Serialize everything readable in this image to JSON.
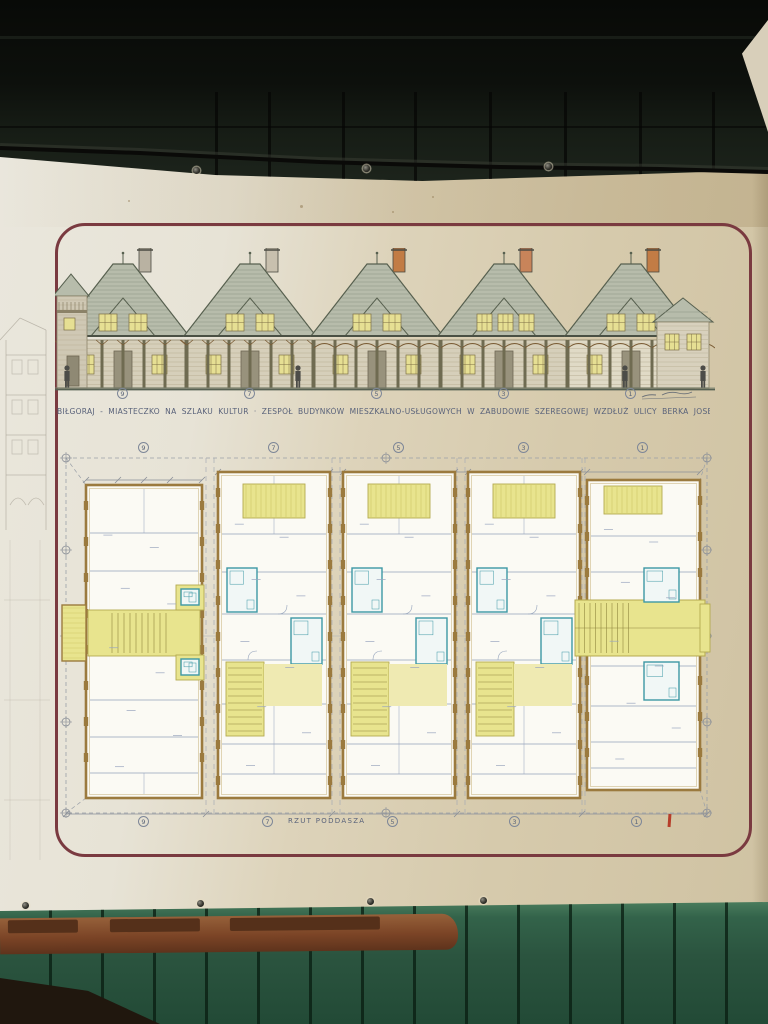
{
  "banner": {
    "caption": "BIŁGORAJ - MIASTECZKO NA SZLAKU KULTUR · ZESPÓŁ BUDYNKÓW MIESZKALNO-USŁUGOWYCH W ZABUDOWIE SZEREGOWEJ WZDŁUŻ ULICY BERKA JOSELEWICZA",
    "plan_label": "RZUT PODDASZA",
    "building_numbers": [
      "9",
      "7",
      "5",
      "3",
      "1"
    ],
    "elevation_numbers": [
      "9",
      "7",
      "5",
      "3",
      "1"
    ]
  },
  "colors": {
    "frame": "#7a3a40",
    "ink": "#5a6478",
    "plan_yellow": "#e8e48e",
    "plan_yellow_dark": "#b4a94f",
    "plan_teal": "#3d98a5",
    "plan_wall_tan": "#9b7a3e",
    "roof_green": "#b7bcab",
    "roof_line": "#57604f",
    "window_yellow": "#e6df93",
    "banner_white": "#e9e6dc",
    "banner_beige": "#cfc2a2",
    "wall_green": "#2f5c42",
    "rail_brown": "#8a5630",
    "red_mark": "#b63e2a"
  }
}
